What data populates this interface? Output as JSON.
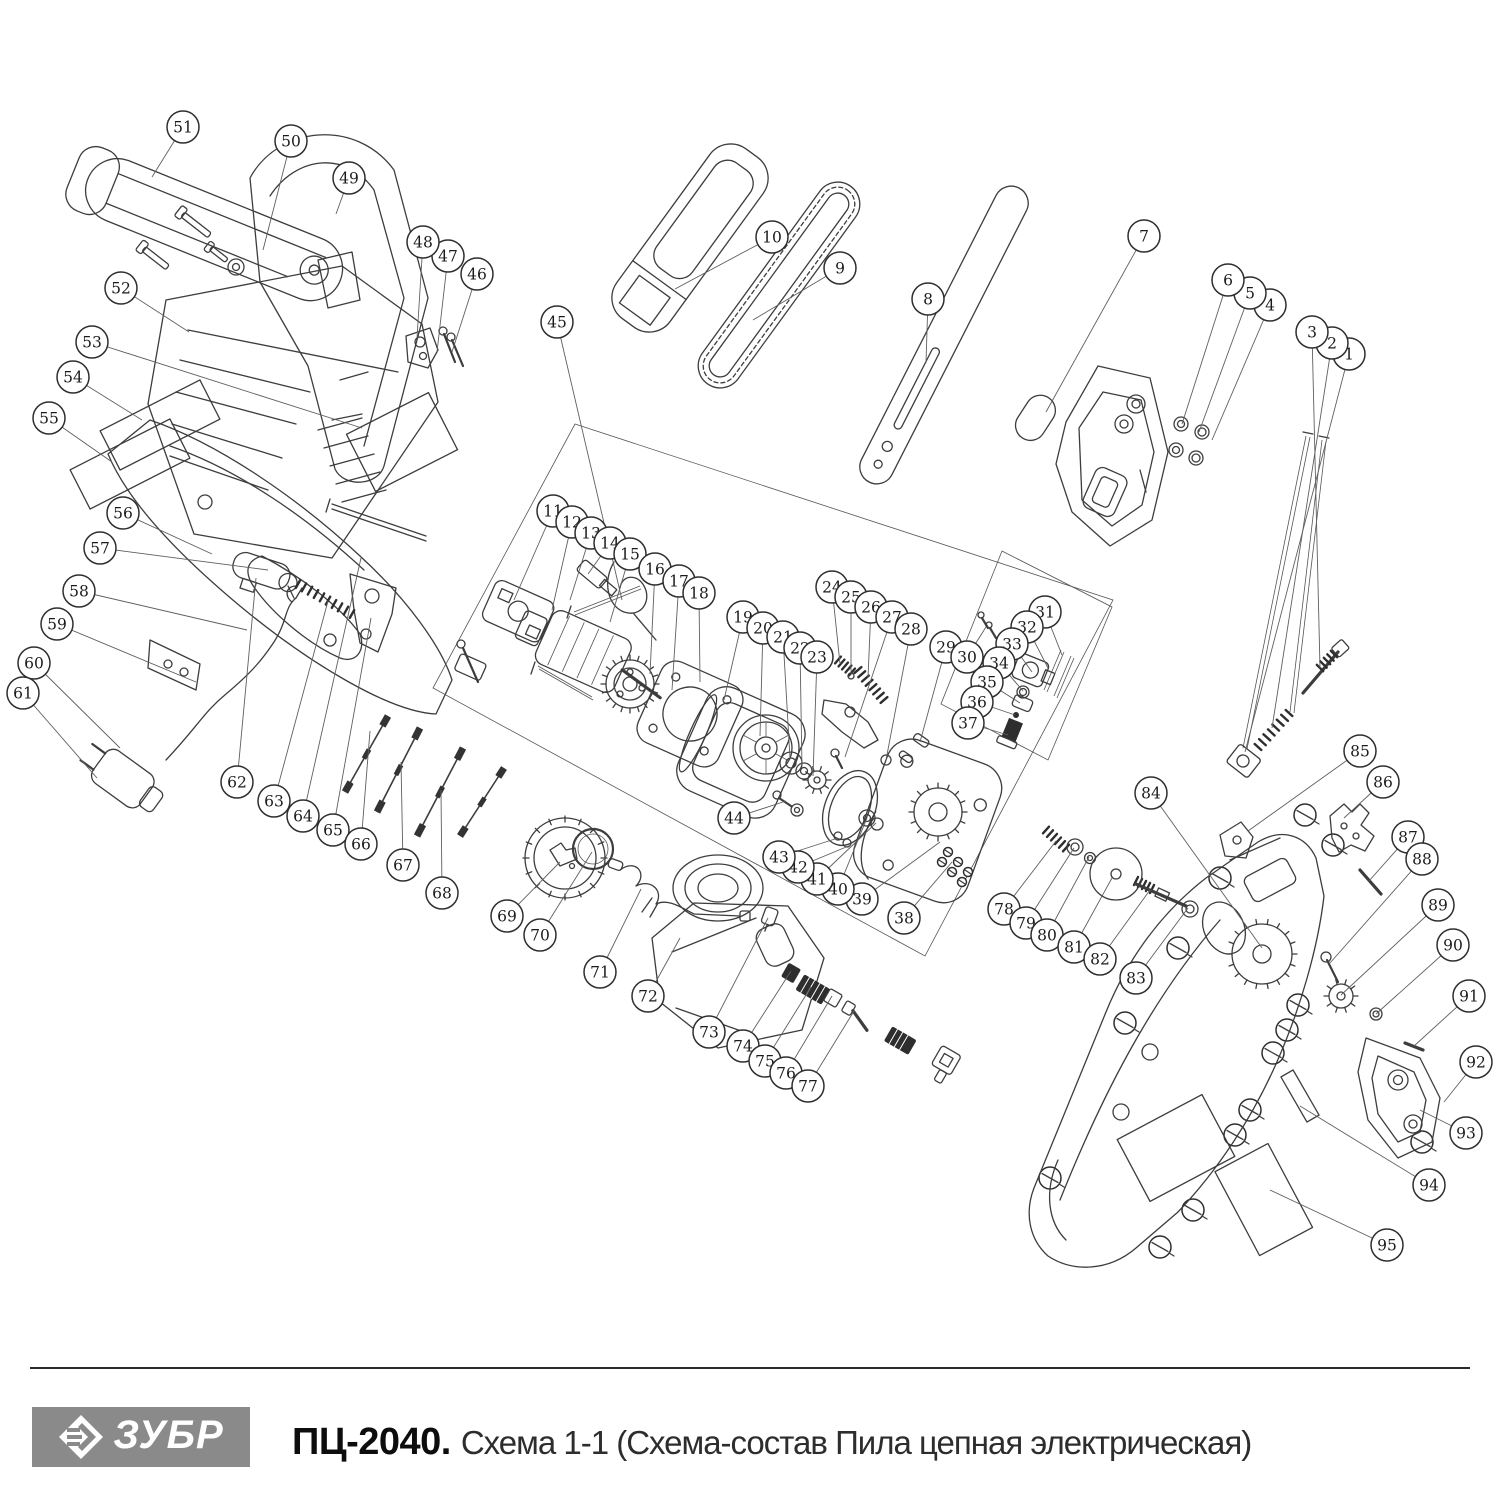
{
  "page": {
    "background": "#ffffff"
  },
  "footer": {
    "divider_color": "#2b2b2b",
    "logo": {
      "text": "ЗУБР",
      "bg": "#8a8a8a",
      "fg": "#ffffff"
    },
    "title_model": "ПЦ-2040.",
    "title_rest": "Схема 1-1 (Схема-состав Пила цепная электрическая)"
  },
  "diagram": {
    "description": "Exploded parts schematic of electric chain saw with numbered callouts",
    "callout_style": {
      "radius": 16,
      "fill": "#ffffff",
      "stroke": "#2e2e2e"
    },
    "callouts": [
      {
        "n": "1",
        "x": 1349,
        "y": 354,
        "tx": 1245,
        "ty": 752
      },
      {
        "n": "2",
        "x": 1332,
        "y": 343,
        "tx": 1272,
        "ty": 728
      },
      {
        "n": "3",
        "x": 1312,
        "y": 332,
        "tx": 1320,
        "ty": 668
      },
      {
        "n": "4",
        "x": 1270,
        "y": 305,
        "tx": 1212,
        "ty": 440
      },
      {
        "n": "5",
        "x": 1250,
        "y": 293,
        "tx": 1199,
        "ty": 432
      },
      {
        "n": "6",
        "x": 1228,
        "y": 280,
        "tx": 1182,
        "ty": 424
      },
      {
        "n": "7",
        "x": 1144,
        "y": 236,
        "tx": 1046,
        "ty": 412
      },
      {
        "n": "8",
        "x": 928,
        "y": 299,
        "tx": 926,
        "ty": 363
      },
      {
        "n": "9",
        "x": 840,
        "y": 268,
        "tx": 753,
        "ty": 320
      },
      {
        "n": "10",
        "x": 772,
        "y": 237,
        "tx": 675,
        "ty": 289
      },
      {
        "n": "11",
        "x": 553,
        "y": 511,
        "tx": 514,
        "ty": 600
      },
      {
        "n": "12",
        "x": 572,
        "y": 522,
        "tx": 552,
        "ty": 610
      },
      {
        "n": "13",
        "x": 591,
        "y": 533,
        "tx": 570,
        "ty": 600
      },
      {
        "n": "14",
        "x": 610,
        "y": 543,
        "tx": 588,
        "ty": 574
      },
      {
        "n": "15",
        "x": 630,
        "y": 554,
        "tx": 610,
        "ty": 622
      },
      {
        "n": "16",
        "x": 655,
        "y": 569,
        "tx": 650,
        "ty": 674
      },
      {
        "n": "17",
        "x": 679,
        "y": 581,
        "tx": 672,
        "ty": 690
      },
      {
        "n": "18",
        "x": 699,
        "y": 593,
        "tx": 700,
        "ty": 682
      },
      {
        "n": "19",
        "x": 743,
        "y": 617,
        "tx": 724,
        "ty": 700
      },
      {
        "n": "20",
        "x": 763,
        "y": 628,
        "tx": 760,
        "ty": 736
      },
      {
        "n": "21",
        "x": 783,
        "y": 637,
        "tx": 790,
        "ty": 758
      },
      {
        "n": "22",
        "x": 800,
        "y": 648,
        "tx": 802,
        "ty": 768
      },
      {
        "n": "23",
        "x": 817,
        "y": 657,
        "tx": 813,
        "ty": 776
      },
      {
        "n": "24",
        "x": 832,
        "y": 587,
        "tx": 840,
        "ty": 664
      },
      {
        "n": "25",
        "x": 851,
        "y": 597,
        "tx": 851,
        "ty": 674
      },
      {
        "n": "26",
        "x": 871,
        "y": 607,
        "tx": 868,
        "ty": 678
      },
      {
        "n": "27",
        "x": 892,
        "y": 617,
        "tx": 845,
        "ty": 757
      },
      {
        "n": "28",
        "x": 911,
        "y": 629,
        "tx": 886,
        "ty": 760
      },
      {
        "n": "29",
        "x": 946,
        "y": 647,
        "tx": 920,
        "ty": 742
      },
      {
        "n": "30",
        "x": 967,
        "y": 657,
        "tx": 986,
        "ty": 627
      },
      {
        "n": "31",
        "x": 1045,
        "y": 612,
        "tx": 1062,
        "ty": 655
      },
      {
        "n": "32",
        "x": 1027,
        "y": 627,
        "tx": 1048,
        "ty": 668
      },
      {
        "n": "33",
        "x": 1012,
        "y": 644,
        "tx": 1032,
        "ty": 672
      },
      {
        "n": "34",
        "x": 999,
        "y": 663,
        "tx": 1023,
        "ty": 691
      },
      {
        "n": "35",
        "x": 987,
        "y": 682,
        "tx": 1020,
        "ty": 703
      },
      {
        "n": "36",
        "x": 977,
        "y": 702,
        "tx": 1015,
        "ty": 715
      },
      {
        "n": "37",
        "x": 968,
        "y": 723,
        "tx": 1008,
        "ty": 735
      },
      {
        "n": "38",
        "x": 904,
        "y": 918,
        "tx": 952,
        "ty": 862
      },
      {
        "n": "39",
        "x": 862,
        "y": 899,
        "tx": 940,
        "ty": 842
      },
      {
        "n": "40",
        "x": 838,
        "y": 889,
        "tx": 867,
        "ty": 818
      },
      {
        "n": "41",
        "x": 817,
        "y": 879,
        "tx": 876,
        "ty": 823
      },
      {
        "n": "42",
        "x": 798,
        "y": 867,
        "tx": 851,
        "ty": 845
      },
      {
        "n": "43",
        "x": 779,
        "y": 857,
        "tx": 838,
        "ty": 838
      },
      {
        "n": "44",
        "x": 734,
        "y": 818,
        "tx": 786,
        "ty": 801
      },
      {
        "n": "45",
        "x": 557,
        "y": 322,
        "tx": 622,
        "ty": 600
      },
      {
        "n": "46",
        "x": 477,
        "y": 274,
        "tx": 452,
        "ty": 352
      },
      {
        "n": "47",
        "x": 448,
        "y": 256,
        "tx": 437,
        "ty": 352
      },
      {
        "n": "48",
        "x": 423,
        "y": 242,
        "tx": 417,
        "ty": 338
      },
      {
        "n": "49",
        "x": 349,
        "y": 178,
        "tx": 336,
        "ty": 214
      },
      {
        "n": "50",
        "x": 291,
        "y": 141,
        "tx": 263,
        "ty": 250
      },
      {
        "n": "51",
        "x": 183,
        "y": 127,
        "tx": 152,
        "ty": 177
      },
      {
        "n": "52",
        "x": 121,
        "y": 288,
        "tx": 189,
        "ty": 332
      },
      {
        "n": "53",
        "x": 92,
        "y": 342,
        "tx": 362,
        "ty": 428
      },
      {
        "n": "54",
        "x": 73,
        "y": 377,
        "tx": 142,
        "ty": 420
      },
      {
        "n": "55",
        "x": 49,
        "y": 418,
        "tx": 112,
        "ty": 462
      },
      {
        "n": "56",
        "x": 123,
        "y": 513,
        "tx": 212,
        "ty": 554
      },
      {
        "n": "57",
        "x": 100,
        "y": 548,
        "tx": 268,
        "ty": 570
      },
      {
        "n": "58",
        "x": 79,
        "y": 591,
        "tx": 247,
        "ty": 630
      },
      {
        "n": "59",
        "x": 57,
        "y": 624,
        "tx": 196,
        "ty": 682
      },
      {
        "n": "60",
        "x": 34,
        "y": 663,
        "tx": 120,
        "ty": 748
      },
      {
        "n": "61",
        "x": 23,
        "y": 693,
        "tx": 97,
        "ty": 778
      },
      {
        "n": "62",
        "x": 237,
        "y": 782,
        "tx": 256,
        "ty": 578
      },
      {
        "n": "63",
        "x": 274,
        "y": 801,
        "tx": 328,
        "ty": 601
      },
      {
        "n": "64",
        "x": 303,
        "y": 816,
        "tx": 361,
        "ty": 558
      },
      {
        "n": "65",
        "x": 333,
        "y": 830,
        "tx": 371,
        "ty": 618
      },
      {
        "n": "66",
        "x": 361,
        "y": 844,
        "tx": 370,
        "ty": 731
      },
      {
        "n": "67",
        "x": 403,
        "y": 865,
        "tx": 401,
        "ty": 762
      },
      {
        "n": "68",
        "x": 442,
        "y": 893,
        "tx": 441,
        "ty": 790
      },
      {
        "n": "69",
        "x": 507,
        "y": 916,
        "tx": 560,
        "ty": 862
      },
      {
        "n": "70",
        "x": 540,
        "y": 935,
        "tx": 592,
        "ty": 852
      },
      {
        "n": "71",
        "x": 600,
        "y": 972,
        "tx": 641,
        "ty": 889
      },
      {
        "n": "72",
        "x": 648,
        "y": 996,
        "tx": 680,
        "ty": 938
      },
      {
        "n": "73",
        "x": 709,
        "y": 1032,
        "tx": 768,
        "ty": 918
      },
      {
        "n": "74",
        "x": 743,
        "y": 1046,
        "tx": 791,
        "ty": 971
      },
      {
        "n": "75",
        "x": 765,
        "y": 1061,
        "tx": 811,
        "ty": 987
      },
      {
        "n": "76",
        "x": 786,
        "y": 1073,
        "tx": 832,
        "ty": 996
      },
      {
        "n": "77",
        "x": 808,
        "y": 1086,
        "tx": 854,
        "ty": 1011
      },
      {
        "n": "78",
        "x": 1004,
        "y": 909,
        "tx": 1056,
        "ty": 841
      },
      {
        "n": "79",
        "x": 1026,
        "y": 923,
        "tx": 1074,
        "ty": 848
      },
      {
        "n": "80",
        "x": 1047,
        "y": 935,
        "tx": 1089,
        "ty": 857
      },
      {
        "n": "81",
        "x": 1074,
        "y": 947,
        "tx": 1112,
        "ty": 878
      },
      {
        "n": "82",
        "x": 1100,
        "y": 959,
        "tx": 1150,
        "ty": 890
      },
      {
        "n": "83",
        "x": 1136,
        "y": 978,
        "tx": 1188,
        "ty": 908
      },
      {
        "n": "84",
        "x": 1151,
        "y": 793,
        "tx": 1262,
        "ty": 948
      },
      {
        "n": "85",
        "x": 1360,
        "y": 751,
        "tx": 1248,
        "ty": 831
      },
      {
        "n": "86",
        "x": 1383,
        "y": 782,
        "tx": 1344,
        "ty": 818
      },
      {
        "n": "87",
        "x": 1408,
        "y": 837,
        "tx": 1369,
        "ty": 881
      },
      {
        "n": "88",
        "x": 1422,
        "y": 859,
        "tx": 1330,
        "ty": 963
      },
      {
        "n": "89",
        "x": 1438,
        "y": 905,
        "tx": 1341,
        "ty": 995
      },
      {
        "n": "90",
        "x": 1453,
        "y": 945,
        "tx": 1376,
        "ty": 1014
      },
      {
        "n": "91",
        "x": 1469,
        "y": 996,
        "tx": 1414,
        "ty": 1046
      },
      {
        "n": "92",
        "x": 1476,
        "y": 1062,
        "tx": 1444,
        "ty": 1102
      },
      {
        "n": "93",
        "x": 1466,
        "y": 1133,
        "tx": 1420,
        "ty": 1110
      },
      {
        "n": "94",
        "x": 1429,
        "y": 1185,
        "tx": 1300,
        "ty": 1106
      },
      {
        "n": "95",
        "x": 1387,
        "y": 1245,
        "tx": 1270,
        "ty": 1190
      }
    ]
  }
}
